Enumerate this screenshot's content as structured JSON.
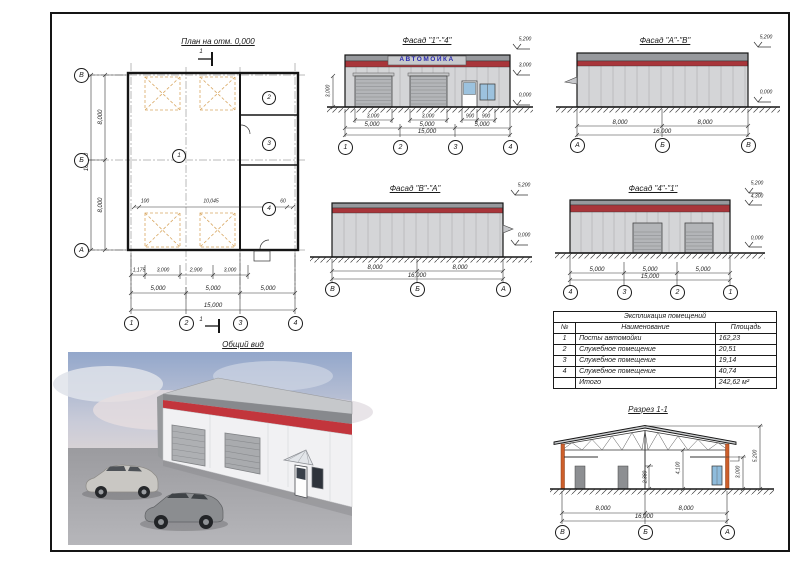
{
  "plan": {
    "title": "План на отм. 0,000",
    "section_mark": "1",
    "axes_bottom": [
      "1",
      "2",
      "3",
      "4"
    ],
    "axes_left": [
      "В",
      "Б",
      "А"
    ],
    "rooms": [
      "1",
      "2",
      "3",
      "4"
    ],
    "dims_sub": [
      "1,175",
      "3,000",
      "2,900",
      "3,000"
    ],
    "dims_main": [
      "5,000",
      "5,000",
      "5,000"
    ],
    "dim_total": "15,000",
    "dims_left": [
      "8,000",
      "8,000"
    ],
    "dim_left_total": "16,000",
    "dims_inner": [
      "100",
      "10,045",
      "60"
    ]
  },
  "facade_1_4": {
    "title": "Фасад \"1\"-\"4\"",
    "sign": "АВТОМОЙКА",
    "door_dims": [
      "3,000",
      "3,000"
    ],
    "entry_dims": [
      "900",
      "900"
    ],
    "height_dim": "3,000",
    "dims_main": [
      "5,000",
      "5,000",
      "5,000"
    ],
    "dim_total": "15,000",
    "axes": [
      "1",
      "2",
      "3",
      "4"
    ],
    "elevations": [
      "5,200",
      "3,000",
      "0,000"
    ]
  },
  "facade_a_b": {
    "title": "Фасад \"А\"-\"В\"",
    "dims_main": [
      "8,000",
      "8,000"
    ],
    "dim_total": "16,000",
    "axes": [
      "А",
      "Б",
      "В"
    ],
    "elev_top": "5,200",
    "elev_bottom": "0,000"
  },
  "facade_b_a": {
    "title": "Фасад \"В\"-\"А\"",
    "dims_main": [
      "8,000",
      "8,000"
    ],
    "dim_total": "16,000",
    "axes": [
      "В",
      "Б",
      "А"
    ],
    "elev_top": "5,200",
    "elev_bottom": "0,000"
  },
  "facade_4_1": {
    "title": "Фасад \"4\"-\"1\"",
    "dims_main": [
      "5,000",
      "5,000",
      "5,000"
    ],
    "dim_total": "15,000",
    "axes": [
      "4",
      "3",
      "2",
      "1"
    ],
    "elevations": [
      "5,200",
      "4,300",
      "0,000"
    ]
  },
  "overview": {
    "title": "Общий вид"
  },
  "rooms_table": {
    "title": "Экспликация помещений",
    "col_num": "№",
    "col_name": "Наименование",
    "col_area": "Площадь",
    "rows": [
      {
        "num": "1",
        "name": "Посты автомойки",
        "area": "162,23"
      },
      {
        "num": "2",
        "name": "Служебное помещение",
        "area": "20,51"
      },
      {
        "num": "3",
        "name": "Служебное помещение",
        "area": "19,14"
      },
      {
        "num": "4",
        "name": "Служебное помещение",
        "area": "40,74"
      },
      {
        "num": "",
        "name": "Итого",
        "area": "242,62 м²"
      }
    ]
  },
  "section": {
    "title": "Разрез 1-1",
    "dims_main": [
      "8,000",
      "8,000"
    ],
    "dim_total": "16,000",
    "axes": [
      "В",
      "Б",
      "А"
    ],
    "height_dims": [
      "2,380",
      "4,100",
      "3,000",
      "5,200"
    ]
  },
  "colors": {
    "band_red": "#a8353a",
    "render_red": "#c2353c",
    "sign_blue": "#2a2ab0",
    "column_orange": "#cd5f2b",
    "wall_gray": "#d4d5d7",
    "roof_gray": "#97999d",
    "window_blue": "#9cc2de",
    "opening_dash": "#d9a863"
  }
}
